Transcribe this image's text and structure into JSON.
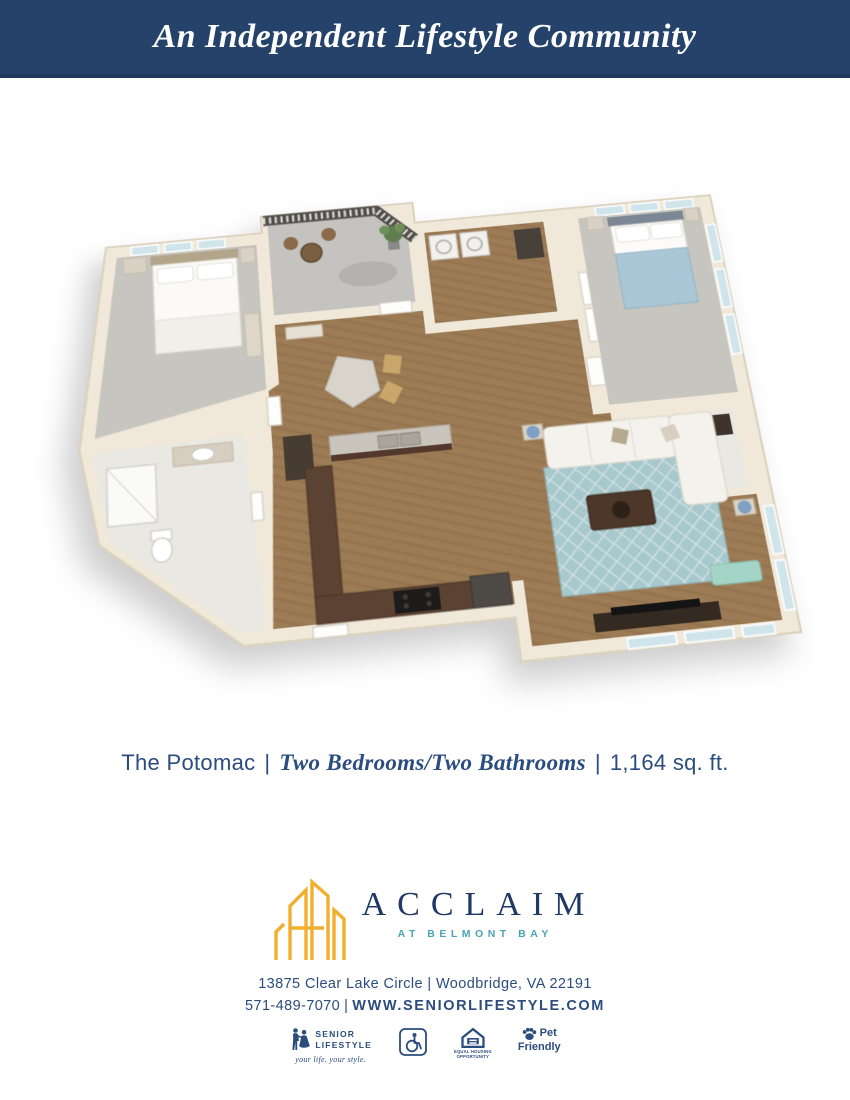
{
  "header": {
    "title": "An Independent Lifestyle Community"
  },
  "brand_colors": {
    "banner_navy": "#25426B",
    "text_navy": "#2B4C7E",
    "logo_navy": "#1F3864",
    "logo_gold": "#F2AF2D",
    "logo_teal": "#4BA4B4"
  },
  "caption": {
    "plan_name": "The Potomac",
    "separator": "|",
    "bed_bath": "Two Bedrooms/Two Bathrooms",
    "area": "1,164 sq. ft."
  },
  "logo": {
    "name": "ACCLAIM",
    "location": "AT BELMONT BAY"
  },
  "contact": {
    "address": "13875 Clear Lake Circle | Woodbridge, VA 22191",
    "phone": "571-489-7070",
    "separator": "|",
    "website": "WWW.SENIORLIFESTYLE.COM"
  },
  "badges": {
    "senior_lifestyle": {
      "line1": "SENIOR",
      "line2": "LIFESTYLE",
      "tagline": "your life. your style."
    },
    "equal_housing": {
      "line1": "EQUAL HOUSING",
      "line2": "OPPORTUNITY"
    },
    "pet_friendly": {
      "line1": "Pet",
      "line2": "Friendly"
    }
  }
}
